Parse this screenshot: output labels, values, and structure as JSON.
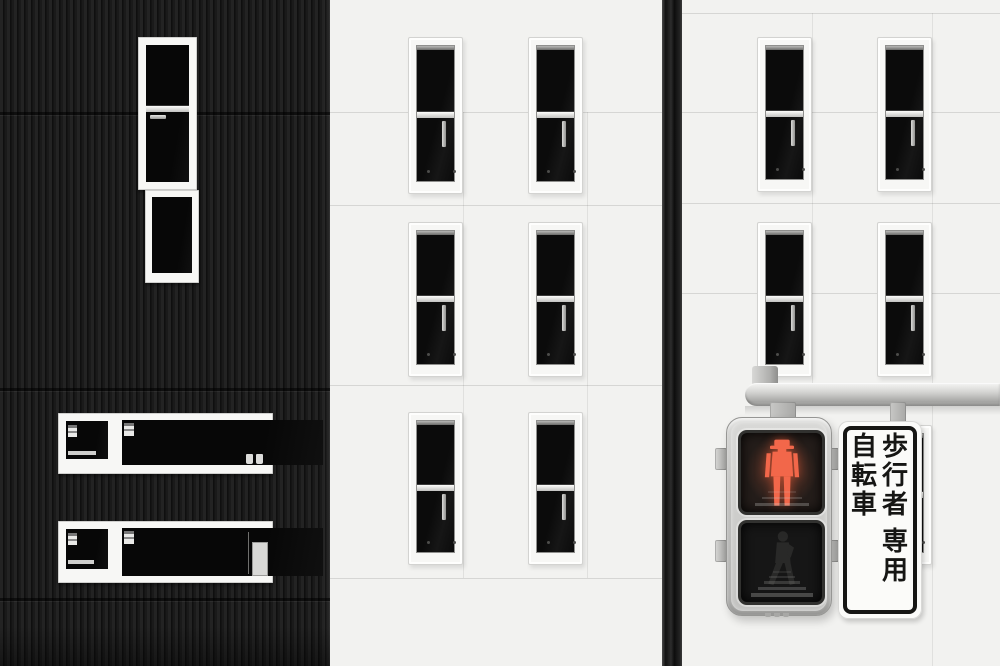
{
  "sign": {
    "full_text": "歩行者自転車専用",
    "columns": [
      {
        "id": "right",
        "chars": [
          "歩",
          "行",
          "者",
          "専",
          "用"
        ],
        "gap_before_index": 3
      },
      {
        "id": "left",
        "chars": [
          "自",
          "転",
          "車"
        ],
        "gap_before_index": -1
      }
    ]
  },
  "signal": {
    "top_lamp": {
      "state": "lit",
      "icon": "standing-person-icon",
      "color": "#f2674a"
    },
    "bottom_lamp": {
      "state": "unlit",
      "icon": "walking-person-icon",
      "color": "#343432"
    }
  },
  "colors": {
    "black_wall": "#1c1c1c",
    "white_wall": "#f2f2f0",
    "window_glass": "#0c0c0c",
    "frame_white": "#f7f7f5",
    "signal_housing": "#c9c9c7",
    "signal_red": "#f2674a",
    "sign_bg": "#fbfbf9",
    "sign_border": "#161614",
    "pole_gray": "#c6c6c4"
  }
}
